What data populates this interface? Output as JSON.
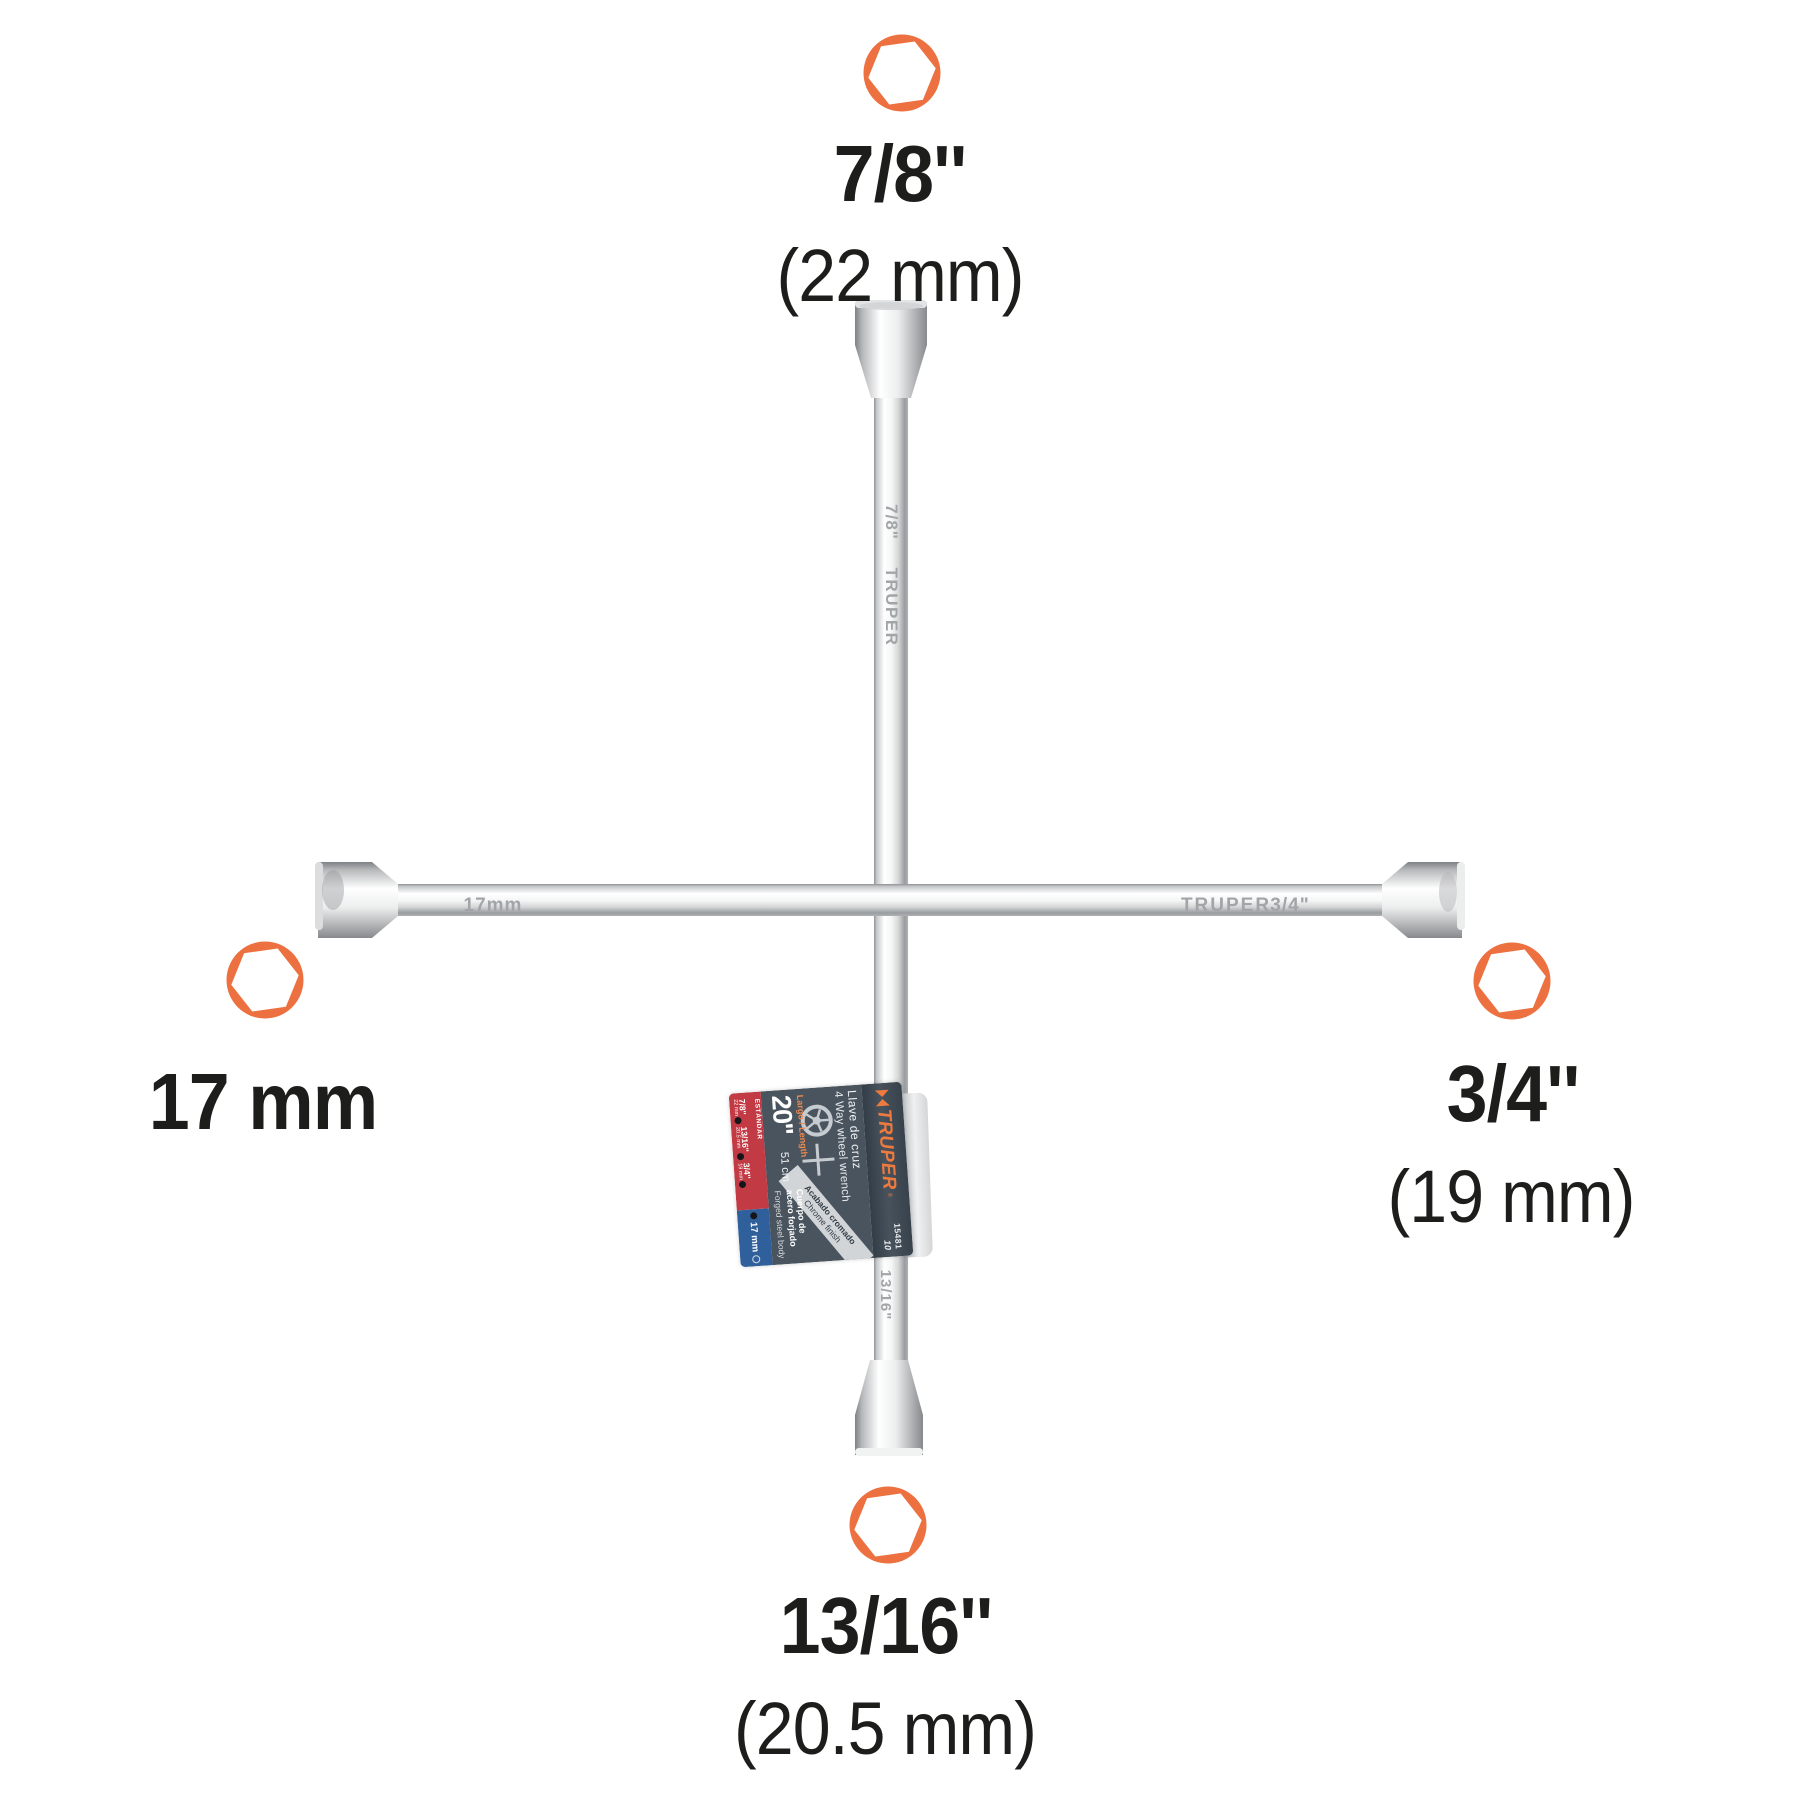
{
  "colors": {
    "accent_orange": "#ed7140",
    "text_black": "#1d1d1b",
    "tag_slate": "#4a545e",
    "tag_band": "#3e4953",
    "tag_red": "#c23a44",
    "tag_blue": "#30609b",
    "ribbon_gray": "#d2d5d8"
  },
  "annotations": {
    "top": {
      "size": "7/8''",
      "metric": "(22 mm)"
    },
    "left": {
      "size": "17 mm"
    },
    "right": {
      "size": "3/4''",
      "metric": "(19 mm)"
    },
    "bottom": {
      "size": "13/16''",
      "metric": "(20.5 mm)"
    }
  },
  "wrench": {
    "engravings": {
      "top_size": "7/8\"",
      "top_brand": "TRUPER",
      "left_size": "17mm",
      "right_brand": "TRUPER",
      "right_size": "3/4\"",
      "bottom_size": "13/16\""
    }
  },
  "tag": {
    "brand": "TRUPER",
    "brand_reg": "®",
    "sku": "15481",
    "warranty": "10",
    "title_es": "Llave de cruz",
    "title_en": "4 Way wheel wrench",
    "length_label": "Largo / Length",
    "length_in": "20''",
    "length_cm": "51 cm",
    "body_es": "Cuerpo de acero forjado",
    "body_en": "Forged steel body",
    "finish_es": "Acabado cromado",
    "finish_en": "Chrome finish",
    "standard_label": "ESTÁNDAR",
    "standard_sizes": [
      {
        "size": "7/8''",
        "mm": "22 mm"
      },
      {
        "size": "13/16''",
        "mm": "20.5 mm"
      },
      {
        "size": "3/4''",
        "mm": "19 mm"
      }
    ],
    "metric_size": "17 mm"
  }
}
